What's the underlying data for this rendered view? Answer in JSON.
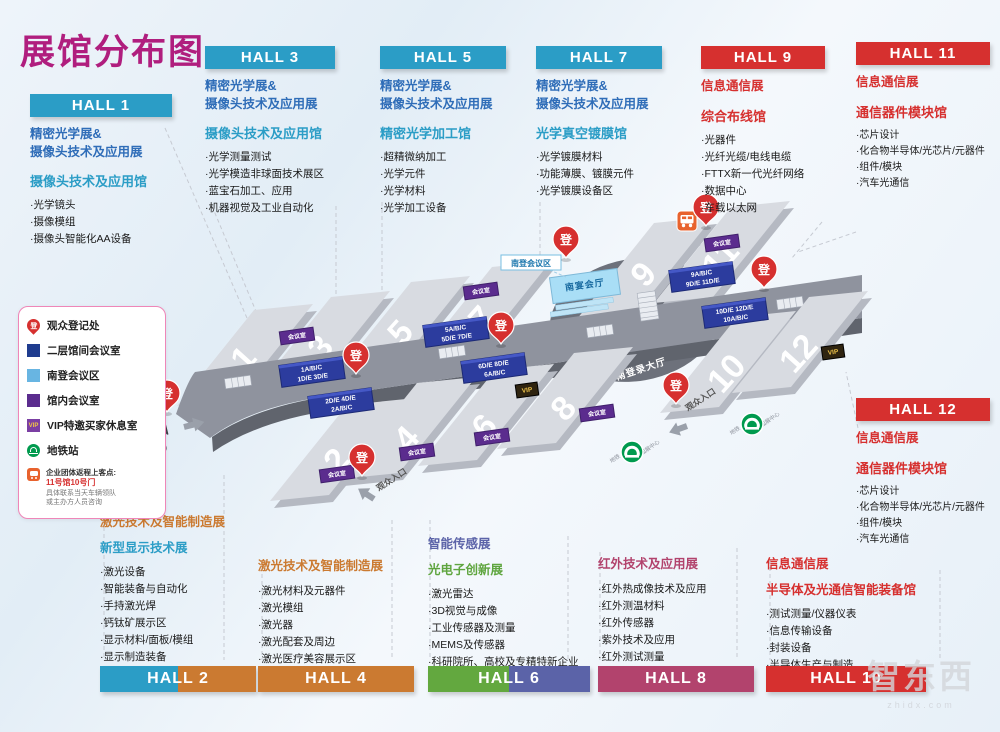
{
  "title": "展馆分布图",
  "colors": {
    "title": "#b01e7e",
    "teal": "#2b9dc6",
    "blue": "#2f6db8",
    "red": "#d6302f",
    "orange": "#cb7a31",
    "green": "#5fa53f",
    "indigo": "#5b63a8",
    "raspberry": "#b2436d",
    "meeting_purple": "#5b2c8e",
    "unit_navy": "#2c3c9e",
    "area_lightblue": "#a9def6",
    "metro_green": "#009a4e",
    "pin_red": "#d6302f",
    "bus_orange": "#e8622d"
  },
  "panels": {
    "hall1": {
      "header": "HALL 1",
      "show1": "精密光学展&",
      "show2": "摄像头技术及应用展",
      "venue": "摄像头技术及应用馆",
      "items": [
        "·光学镜头",
        "·摄像模组",
        "·摄像头智能化AA设备"
      ]
    },
    "hall3": {
      "header": "HALL 3",
      "show1": "精密光学展&",
      "show2": "摄像头技术及应用展",
      "venue": "摄像头技术及应用馆",
      "items": [
        "·光学测量测试",
        "·光学模造非球面技术展区",
        "·蓝宝石加工、应用",
        "·机器视觉及工业自动化"
      ]
    },
    "hall5": {
      "header": "HALL 5",
      "show1": "精密光学展&",
      "show2": "摄像头技术及应用展",
      "venue": "精密光学加工馆",
      "items": [
        "·超精微纳加工",
        "·光学元件",
        "·光学材料",
        "·光学加工设备"
      ]
    },
    "hall7": {
      "header": "HALL 7",
      "show1": "精密光学展&",
      "show2": "摄像头技术及应用展",
      "venue": "光学真空镀膜馆",
      "items": [
        "·光学镀膜材料",
        "·功能薄膜、镀膜元件",
        "·光学镀膜设备区"
      ]
    },
    "hall9": {
      "header": "HALL 9",
      "show1": "信息通信展",
      "venue": "综合布线馆",
      "items": [
        "·光器件",
        "·光纤光缆/电线电缆",
        "·FTTX新一代光纤网络",
        "·数据中心",
        "·车载以太网"
      ]
    },
    "hall11": {
      "header": "HALL 11",
      "show1": "信息通信展",
      "venue": "通信器件模块馆",
      "items": [
        "·芯片设计",
        "·化合物半导体/光芯片/元器件",
        "·组件/模块",
        "·汽车光通信"
      ]
    },
    "hall12": {
      "header": "HALL 12",
      "show1": "信息通信展",
      "venue": "通信器件模块馆",
      "items": [
        "·芯片设计",
        "·化合物半导体/光芯片/元器件",
        "·组件/模块",
        "·汽车光通信"
      ]
    },
    "hall2": {
      "header": "HALL 2",
      "show1": "激光技术及智能制造展",
      "show2": "新型显示技术展",
      "items": [
        "·激光设备",
        "·智能装备与自动化",
        "·手持激光焊",
        "·钙钛矿展示区",
        "·显示材料/面板/模组",
        "·显示制造装备",
        "·AR/VR产品及创新应用"
      ]
    },
    "hall4": {
      "header": "HALL 4",
      "show1": "激光技术及智能制造展",
      "items": [
        "·激光材料及元器件",
        "·激光模组",
        "·激光器",
        "·激光配套及周边",
        "·激光医疗美容展示区"
      ]
    },
    "hall6": {
      "header": "HALL 6",
      "show1": "智能传感展",
      "show2": "光电子创新展",
      "items": [
        "·激光雷达",
        "·3D视觉与成像",
        "·工业传感器及测量",
        "·MEMS及传感器",
        "·科研院所、高校及专精特新企业"
      ]
    },
    "hall8": {
      "header": "HALL 8",
      "show1": "红外技术及应用展",
      "items": [
        "·红外热成像技术及应用",
        "·红外测温材料",
        "·红外传感器",
        "·紫外技术及应用",
        "·红外测试测量"
      ]
    },
    "hall10": {
      "header": "HALL 10",
      "show1": "信息通信展",
      "venue": "半导体及光通信智能装备馆",
      "items": [
        "·测试测量/仪器仪表",
        "·信息传输设备",
        "·封装设备",
        "·半导体生产与制造"
      ]
    }
  },
  "legend": {
    "items": [
      {
        "icon": "registration-pin",
        "label": "观众登记处"
      },
      {
        "icon": "navy-square",
        "label": "二层馆间会议室"
      },
      {
        "icon": "lightblue-square",
        "label": "南登会议区"
      },
      {
        "icon": "purple-square",
        "label": "馆内会议室"
      },
      {
        "icon": "vip-badge",
        "label": "VIP特邀买家休息室"
      },
      {
        "icon": "metro-badge",
        "label": "地铁站"
      }
    ],
    "bus_note": {
      "line1": "企业团体返程上客点:",
      "line2": "11号馆10号门",
      "line3": "具体联系当天车辆领队",
      "line4": "或主办方人员咨询"
    }
  },
  "map": {
    "numbers": [
      "1",
      "2",
      "3",
      "4",
      "5",
      "6",
      "7",
      "8",
      "9",
      "10",
      "11",
      "12"
    ],
    "pin": "登",
    "meeting_room": "会议室",
    "vip": "VIP",
    "south_meeting_area": "南登会议区",
    "banquet_hall": "南宴会厅",
    "registration_hall": "南登录大厅",
    "south_entrance": "南入口",
    "south_square": "(南广场)",
    "visitor_entrance": "观众入口",
    "metro_left": "地铁",
    "metro_right": "国展中心",
    "clusters": [
      {
        "l1": "1A/B/C",
        "l2": "1D/E 3D/E"
      },
      {
        "l1": "2D/E 4D/E",
        "l2": "2A/B/C"
      },
      {
        "l1": "5A/B/C",
        "l2": "5D/E 7D/E"
      },
      {
        "l1": "6D/E 8D/E",
        "l2": "6A/B/C"
      },
      {
        "l1": "9A/B/C",
        "l2": "9D/E 11D/E"
      },
      {
        "l1": "10D/E 12D/E",
        "l2": "10A/B/C"
      }
    ]
  },
  "watermark": {
    "text": "智东西",
    "sub": "zhidx.com"
  }
}
